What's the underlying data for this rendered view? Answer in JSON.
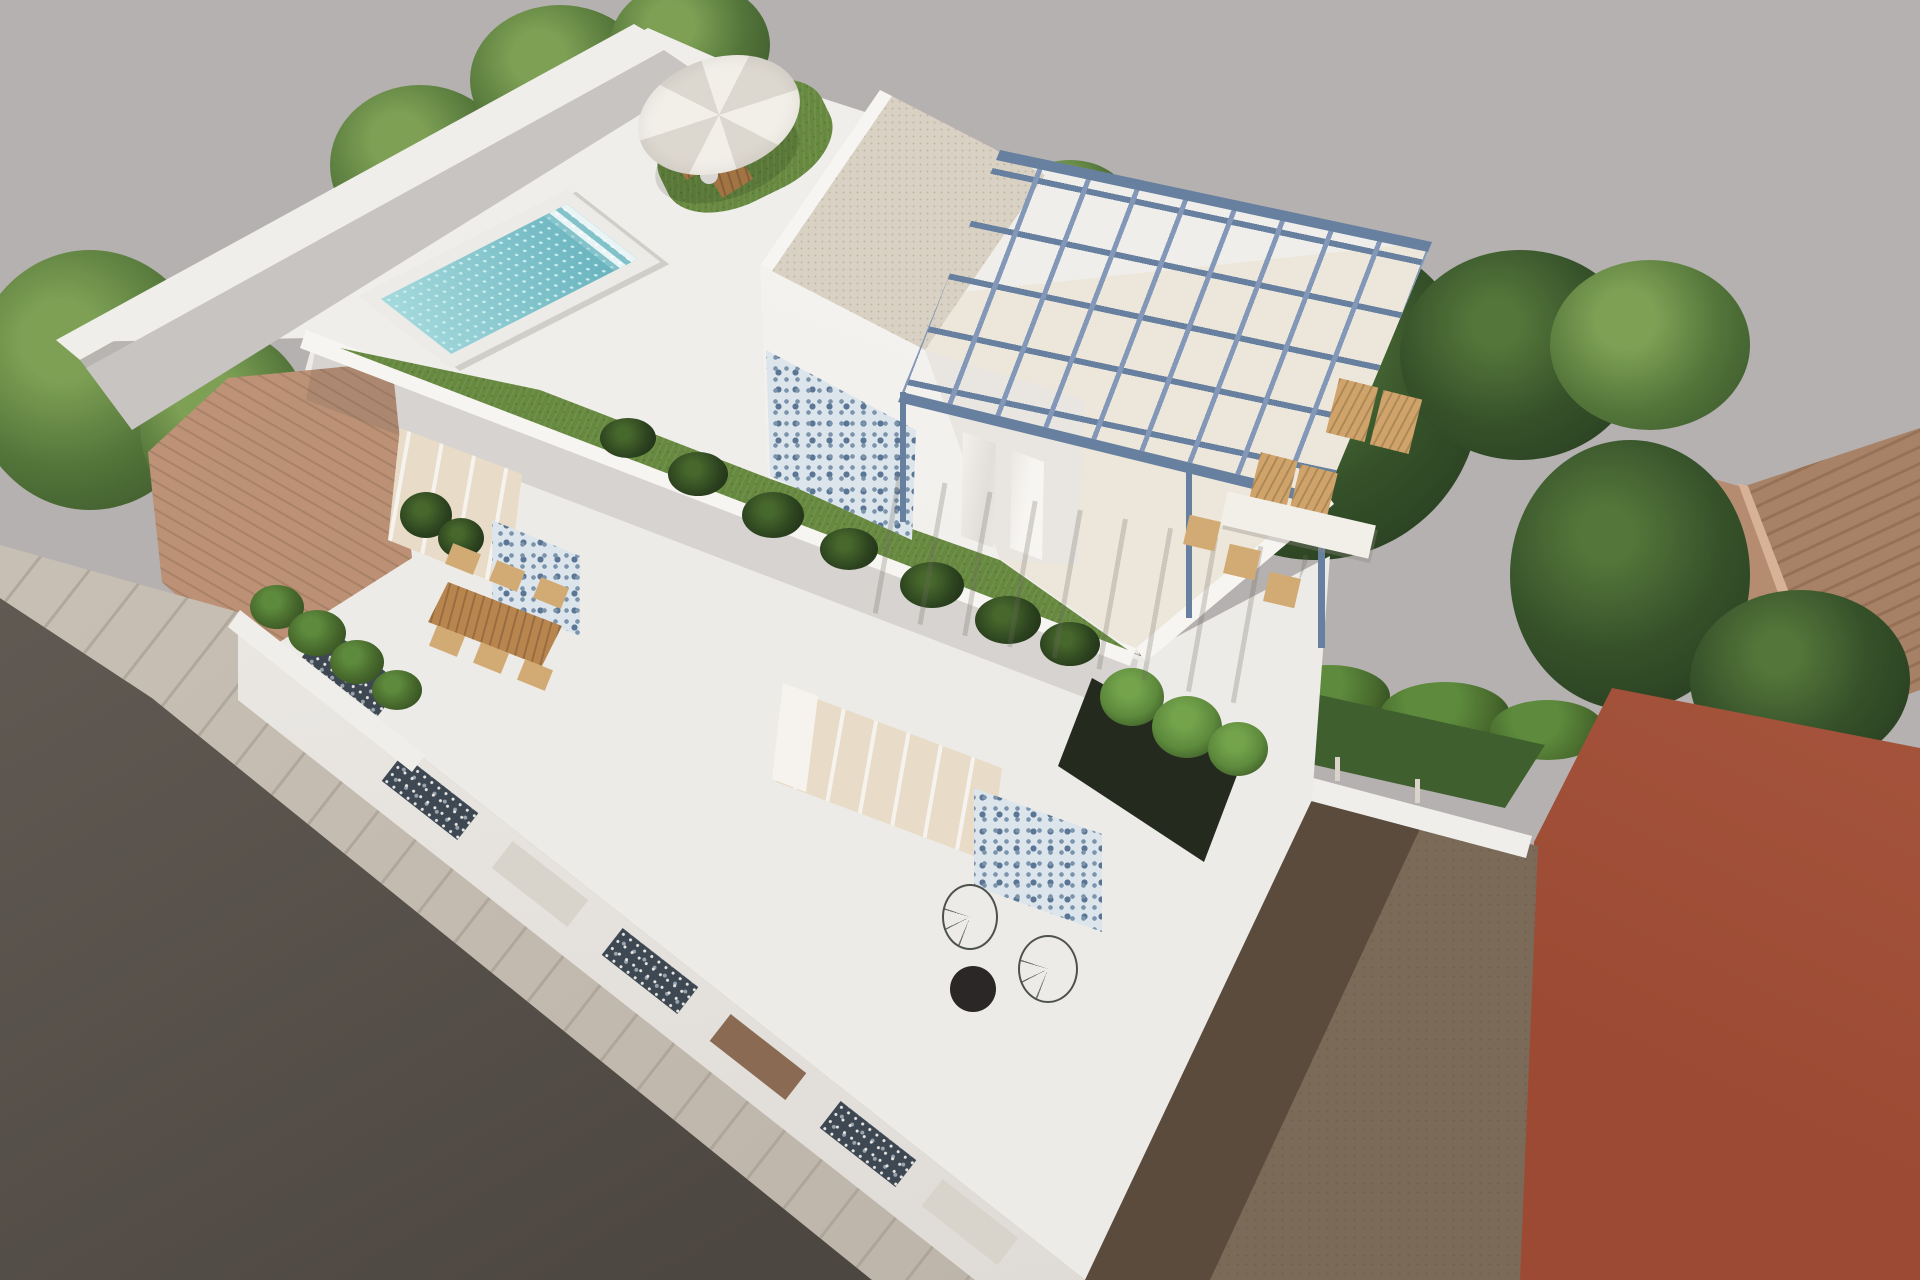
{
  "image": {
    "kind": "3d-architectural-render",
    "subject": "Aerial view of a modern white two-storey villa with rooftop pool terrace, blue steel pergola, patterned tile accents, surrounded by trees, terracotta-roof neighbours, a dirt yard, a red building and a street",
    "width": 1920,
    "height": 1280
  },
  "scene": {
    "elements": [
      "ground-backdrop",
      "street-asphalt",
      "sidewalk",
      "boundary-fence-wall",
      "neighbour-terracotta-roof-left",
      "neighbour-gable-roof-right",
      "trees",
      "hedges",
      "red-building",
      "dirt-yard",
      "main-villa-body",
      "street-facade",
      "facade-window-shutters",
      "mid-terrace",
      "mid-terrace-dining-table",
      "rooftop-terrace",
      "swimming-pool",
      "sun-parasol",
      "sun-loungers",
      "rooftop-box",
      "blue-mosaic-tile-walls",
      "steel-pergola",
      "pergola-dining-set",
      "acapulco-wire-chairs",
      "round-black-table",
      "banana-plants",
      "rooftop-lawn"
    ],
    "palette": {
      "bg": "#b4b1b0",
      "road_light": "#6b645d",
      "road_dark": "#4d4741",
      "sidewalk": "#b9b0a5",
      "sidewalk_light": "#cbc3b8",
      "sidewalk_joint": "#a59c90",
      "white_top": "#f7f5f2",
      "white_wall": "#f0eeea",
      "white_mid": "#edebe7",
      "white_shade": "#e9e6e1",
      "gray_face": "#b7b4b1",
      "walkway": "#c8c4c1",
      "floor_cream": "#ece5d9",
      "facade_light": "#f3f1ee",
      "facade_shade": "#ddd9d4",
      "grass": "#66893f",
      "plant_dark": "#2c421f",
      "plant_mid": "#47682c",
      "plant_bright": "#5d8a3c",
      "tree_light": "#7da055",
      "tree_mid": "#54763a",
      "tree_dark": "#36522a",
      "tree_deep": "#24381d",
      "pool_deck": "#ecebe7",
      "water1": "#a5dadd",
      "water2": "#62afbb",
      "water_dot": "#c8ecee",
      "tile_blue": "#7b94ac",
      "tile_blue_dark": "#5a7694",
      "tile_bg": "#dde5ec",
      "darktile_bg": "#3e4852",
      "darktile_dot": "#e8e6e2",
      "box_roof": "#d9d1c3",
      "box_speckle": "#c2b8a6",
      "pergola": "#8398b8",
      "pergola_dark": "#68809f",
      "wood": "#b9854e",
      "wood_light": "#cfa369",
      "wicker": "#d2ab74",
      "terracotta_light": "#c19579",
      "terracotta_dark": "#ad866a",
      "terracotta_line": "#8a6a52",
      "dirt": "#7b6a57",
      "dirt_shadow": "#57493b",
      "red_wall": "#9c4a33",
      "red_wall_light": "#ab5a42",
      "glass": "#e8dcc8",
      "curtain": "#f6f3ee",
      "opening_dark": "#242b1e",
      "table_black": "#2b2726",
      "wire": "#4e524d",
      "slot_light": "#d8d3cb",
      "slot_brown": "#8a6a52"
    }
  }
}
